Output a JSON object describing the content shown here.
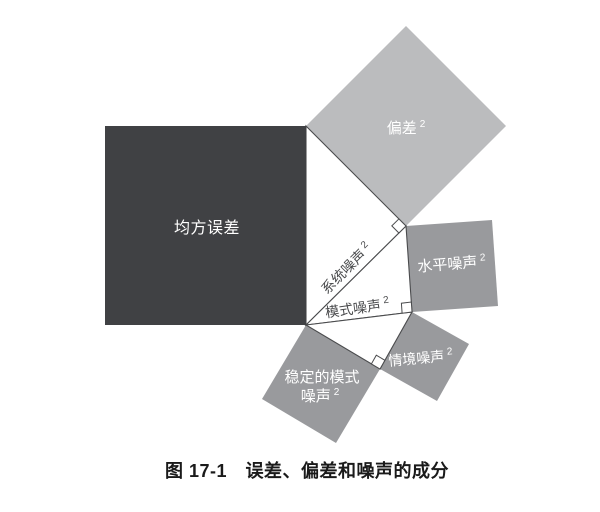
{
  "colors": {
    "background": "#ffffff",
    "mse_square": "#404144",
    "bias_square": "#bbbcbe",
    "noise_square": "#999a9d",
    "triangle_fill": "#ffffff",
    "line": "#4a4b4d",
    "label_on_square": "#ffffff",
    "label_in_triangle": "#4a4b4d",
    "caption_text": "#1a1a1a"
  },
  "labels": {
    "mse": {
      "base": "均方误差"
    },
    "bias": {
      "base": "偏差",
      "sup": "2"
    },
    "system_noise": {
      "base": "系统噪声",
      "sup": "2"
    },
    "pattern_noise": {
      "base": "模式噪声",
      "sup": "2"
    },
    "level_noise": {
      "base": "水平噪声",
      "sup": "2"
    },
    "occasion_noise": {
      "base": "情境噪声",
      "sup": "2"
    },
    "stable_pattern_noise": {
      "line1": "稳定的模式",
      "line2_base": "噪声",
      "line2_sup": "2"
    }
  },
  "caption": {
    "text": "图 17-1　误差、偏差和噪声的成分"
  }
}
